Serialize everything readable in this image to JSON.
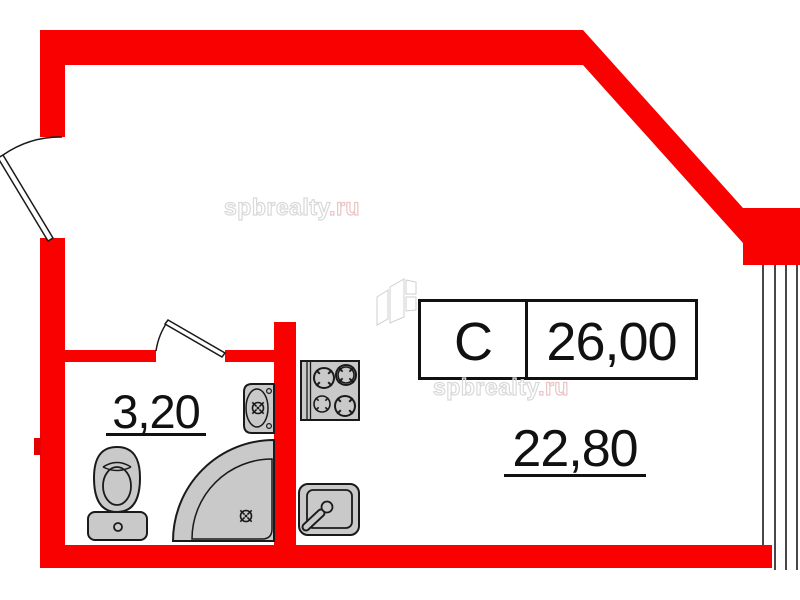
{
  "page": {
    "background": "#ffffff",
    "kind": "apartment floor plan"
  },
  "unit_label": {
    "type_code": "С",
    "total_area": "26,00"
  },
  "rooms": {
    "main": {
      "area": "22,80"
    },
    "bathroom": {
      "area": "3,20"
    }
  },
  "watermarks": {
    "first": {
      "main": "spbrealty",
      "suffix": ".ru"
    },
    "second": {
      "main": "spbrealty",
      "suffix": ".ru"
    }
  },
  "fixtures": [
    "entrance-door",
    "bathroom-door",
    "toilet",
    "shower-tray",
    "bathroom-sink",
    "stove",
    "kitchen-sink",
    "window",
    "folding-screen-logo"
  ],
  "colors": {
    "wall_red": "#f80100",
    "wall_red_dark": "#e30000",
    "fixture_gray": "#c9c9c9",
    "outline_black": "#1a1a1a",
    "watermark_gray": "#d9d9d9",
    "watermark_pink": "#eac6c6"
  }
}
